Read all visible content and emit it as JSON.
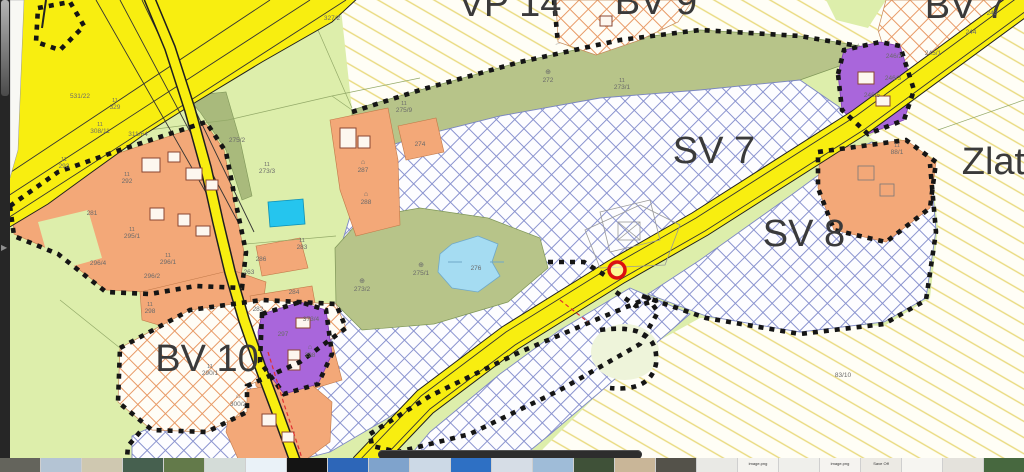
{
  "map": {
    "colors": {
      "base": "#ddeeab",
      "road": "#f8ee10",
      "olive": "#b7c489",
      "orange": "#f3a878",
      "purple": "#a966db",
      "cyan": "#25c5ee",
      "pond": "#a5dcf2",
      "dotted": "#151515",
      "label_big": "#3a3a3a",
      "label_small": "#6a6a6a",
      "marker_red": "#dd0f0f",
      "strip_bg": "#262626",
      "bar": "#2d2d2d"
    },
    "zone_labels": [
      {
        "text": "VP 14",
        "x": 510,
        "y": 16
      },
      {
        "text": "BV 9",
        "x": 656,
        "y": 14
      },
      {
        "text": "BV 7",
        "x": 966,
        "y": 18
      },
      {
        "text": "SV 7",
        "x": 714,
        "y": 163
      },
      {
        "text": "SV 8",
        "x": 804,
        "y": 246
      },
      {
        "text": "BV 10",
        "x": 207,
        "y": 371
      },
      {
        "text": "Zlatá",
        "x": 1004,
        "y": 174
      }
    ],
    "parcel_labels": [
      {
        "t": "327/2",
        "x": 332,
        "y": 20
      },
      {
        "t": "531/22",
        "x": 80,
        "y": 98
      },
      {
        "t": "329",
        "x": 115,
        "y": 109,
        "top": "11"
      },
      {
        "t": "308/11",
        "x": 100,
        "y": 133,
        "top": "11"
      },
      {
        "t": "311/64",
        "x": 138,
        "y": 136
      },
      {
        "t": "275/2",
        "x": 237,
        "y": 142
      },
      {
        "t": "273/3",
        "x": 267,
        "y": 173,
        "top": "11"
      },
      {
        "t": "293",
        "x": 64,
        "y": 168,
        "top": "11"
      },
      {
        "t": "292",
        "x": 127,
        "y": 183,
        "top": "11"
      },
      {
        "t": "281",
        "x": 92,
        "y": 215
      },
      {
        "t": "295/1",
        "x": 132,
        "y": 238,
        "top": "11"
      },
      {
        "t": "296/4",
        "x": 98,
        "y": 265
      },
      {
        "t": "296/1",
        "x": 168,
        "y": 264,
        "top": "11"
      },
      {
        "t": "296/2",
        "x": 152,
        "y": 278
      },
      {
        "t": "283",
        "x": 302,
        "y": 249,
        "top": "11"
      },
      {
        "t": "286",
        "x": 261,
        "y": 261
      },
      {
        "t": "263",
        "x": 249,
        "y": 274
      },
      {
        "t": "287",
        "x": 363,
        "y": 172,
        "sym": "⌂"
      },
      {
        "t": "288",
        "x": 366,
        "y": 204,
        "sym": "⌂"
      },
      {
        "t": "274",
        "x": 420,
        "y": 146
      },
      {
        "t": "275/9",
        "x": 404,
        "y": 112,
        "top": "11"
      },
      {
        "t": "272",
        "x": 548,
        "y": 82,
        "sym": "⊕"
      },
      {
        "t": "273/1",
        "x": 622,
        "y": 89,
        "top": "11"
      },
      {
        "t": "273/2",
        "x": 362,
        "y": 291,
        "sym": "⊕"
      },
      {
        "t": "275/1",
        "x": 421,
        "y": 275,
        "sym": "⊕"
      },
      {
        "t": "276",
        "x": 476,
        "y": 270
      },
      {
        "t": "83/10",
        "x": 843,
        "y": 377
      },
      {
        "t": "88/1",
        "x": 897,
        "y": 154,
        "top": "11"
      },
      {
        "t": "243",
        "x": 992,
        "y": 15
      },
      {
        "t": "244",
        "x": 971,
        "y": 34
      },
      {
        "t": "245/1",
        "x": 933,
        "y": 55
      },
      {
        "t": "246/2",
        "x": 894,
        "y": 58
      },
      {
        "t": "246/3",
        "x": 893,
        "y": 80
      },
      {
        "t": "246/5",
        "x": 872,
        "y": 97
      },
      {
        "t": "373/4",
        "x": 311,
        "y": 321
      },
      {
        "t": "297",
        "x": 283,
        "y": 336
      },
      {
        "t": "298",
        "x": 310,
        "y": 357,
        "sym": "⌂"
      },
      {
        "t": "290/1",
        "x": 210,
        "y": 375,
        "top": "11"
      },
      {
        "t": "300/2",
        "x": 238,
        "y": 406,
        "sym": "⌂"
      },
      {
        "t": "298",
        "x": 150,
        "y": 313,
        "top": "11"
      },
      {
        "t": "282",
        "x": 258,
        "y": 311
      },
      {
        "t": "284",
        "x": 294,
        "y": 294
      }
    ],
    "marker": {
      "x": 617,
      "y": 270
    }
  },
  "filmstrip": {
    "thumbnails": [
      {
        "c": "#64645c"
      },
      {
        "c": "#b4c4d4"
      },
      {
        "c": "#cfc8b0"
      },
      {
        "c": "#46604f"
      },
      {
        "c": "#637a4a"
      },
      {
        "c": "#d4dcd8"
      },
      {
        "c": "#eaf2f8"
      },
      {
        "c": "#141414"
      },
      {
        "c": "#2d66b8"
      },
      {
        "c": "#7fa3cc"
      },
      {
        "c": "#ccd9e6"
      },
      {
        "c": "#2e70c4"
      },
      {
        "c": "#d6dde6"
      },
      {
        "c": "#9fbcd8"
      },
      {
        "c": "#3f5138"
      },
      {
        "c": "#c9b698"
      },
      {
        "c": "#54524a"
      },
      {
        "c": "#e9e9e5"
      },
      {
        "c": "#f4f3ef",
        "cap": "image.png"
      },
      {
        "c": "#efefeb"
      },
      {
        "c": "#f5f3f0",
        "cap": "image.png"
      },
      {
        "c": "#eceae4",
        "cap": "Save Off"
      },
      {
        "c": "#f6f5f1"
      },
      {
        "c": "#e4e2dc"
      },
      {
        "c": "#47683f"
      }
    ]
  }
}
